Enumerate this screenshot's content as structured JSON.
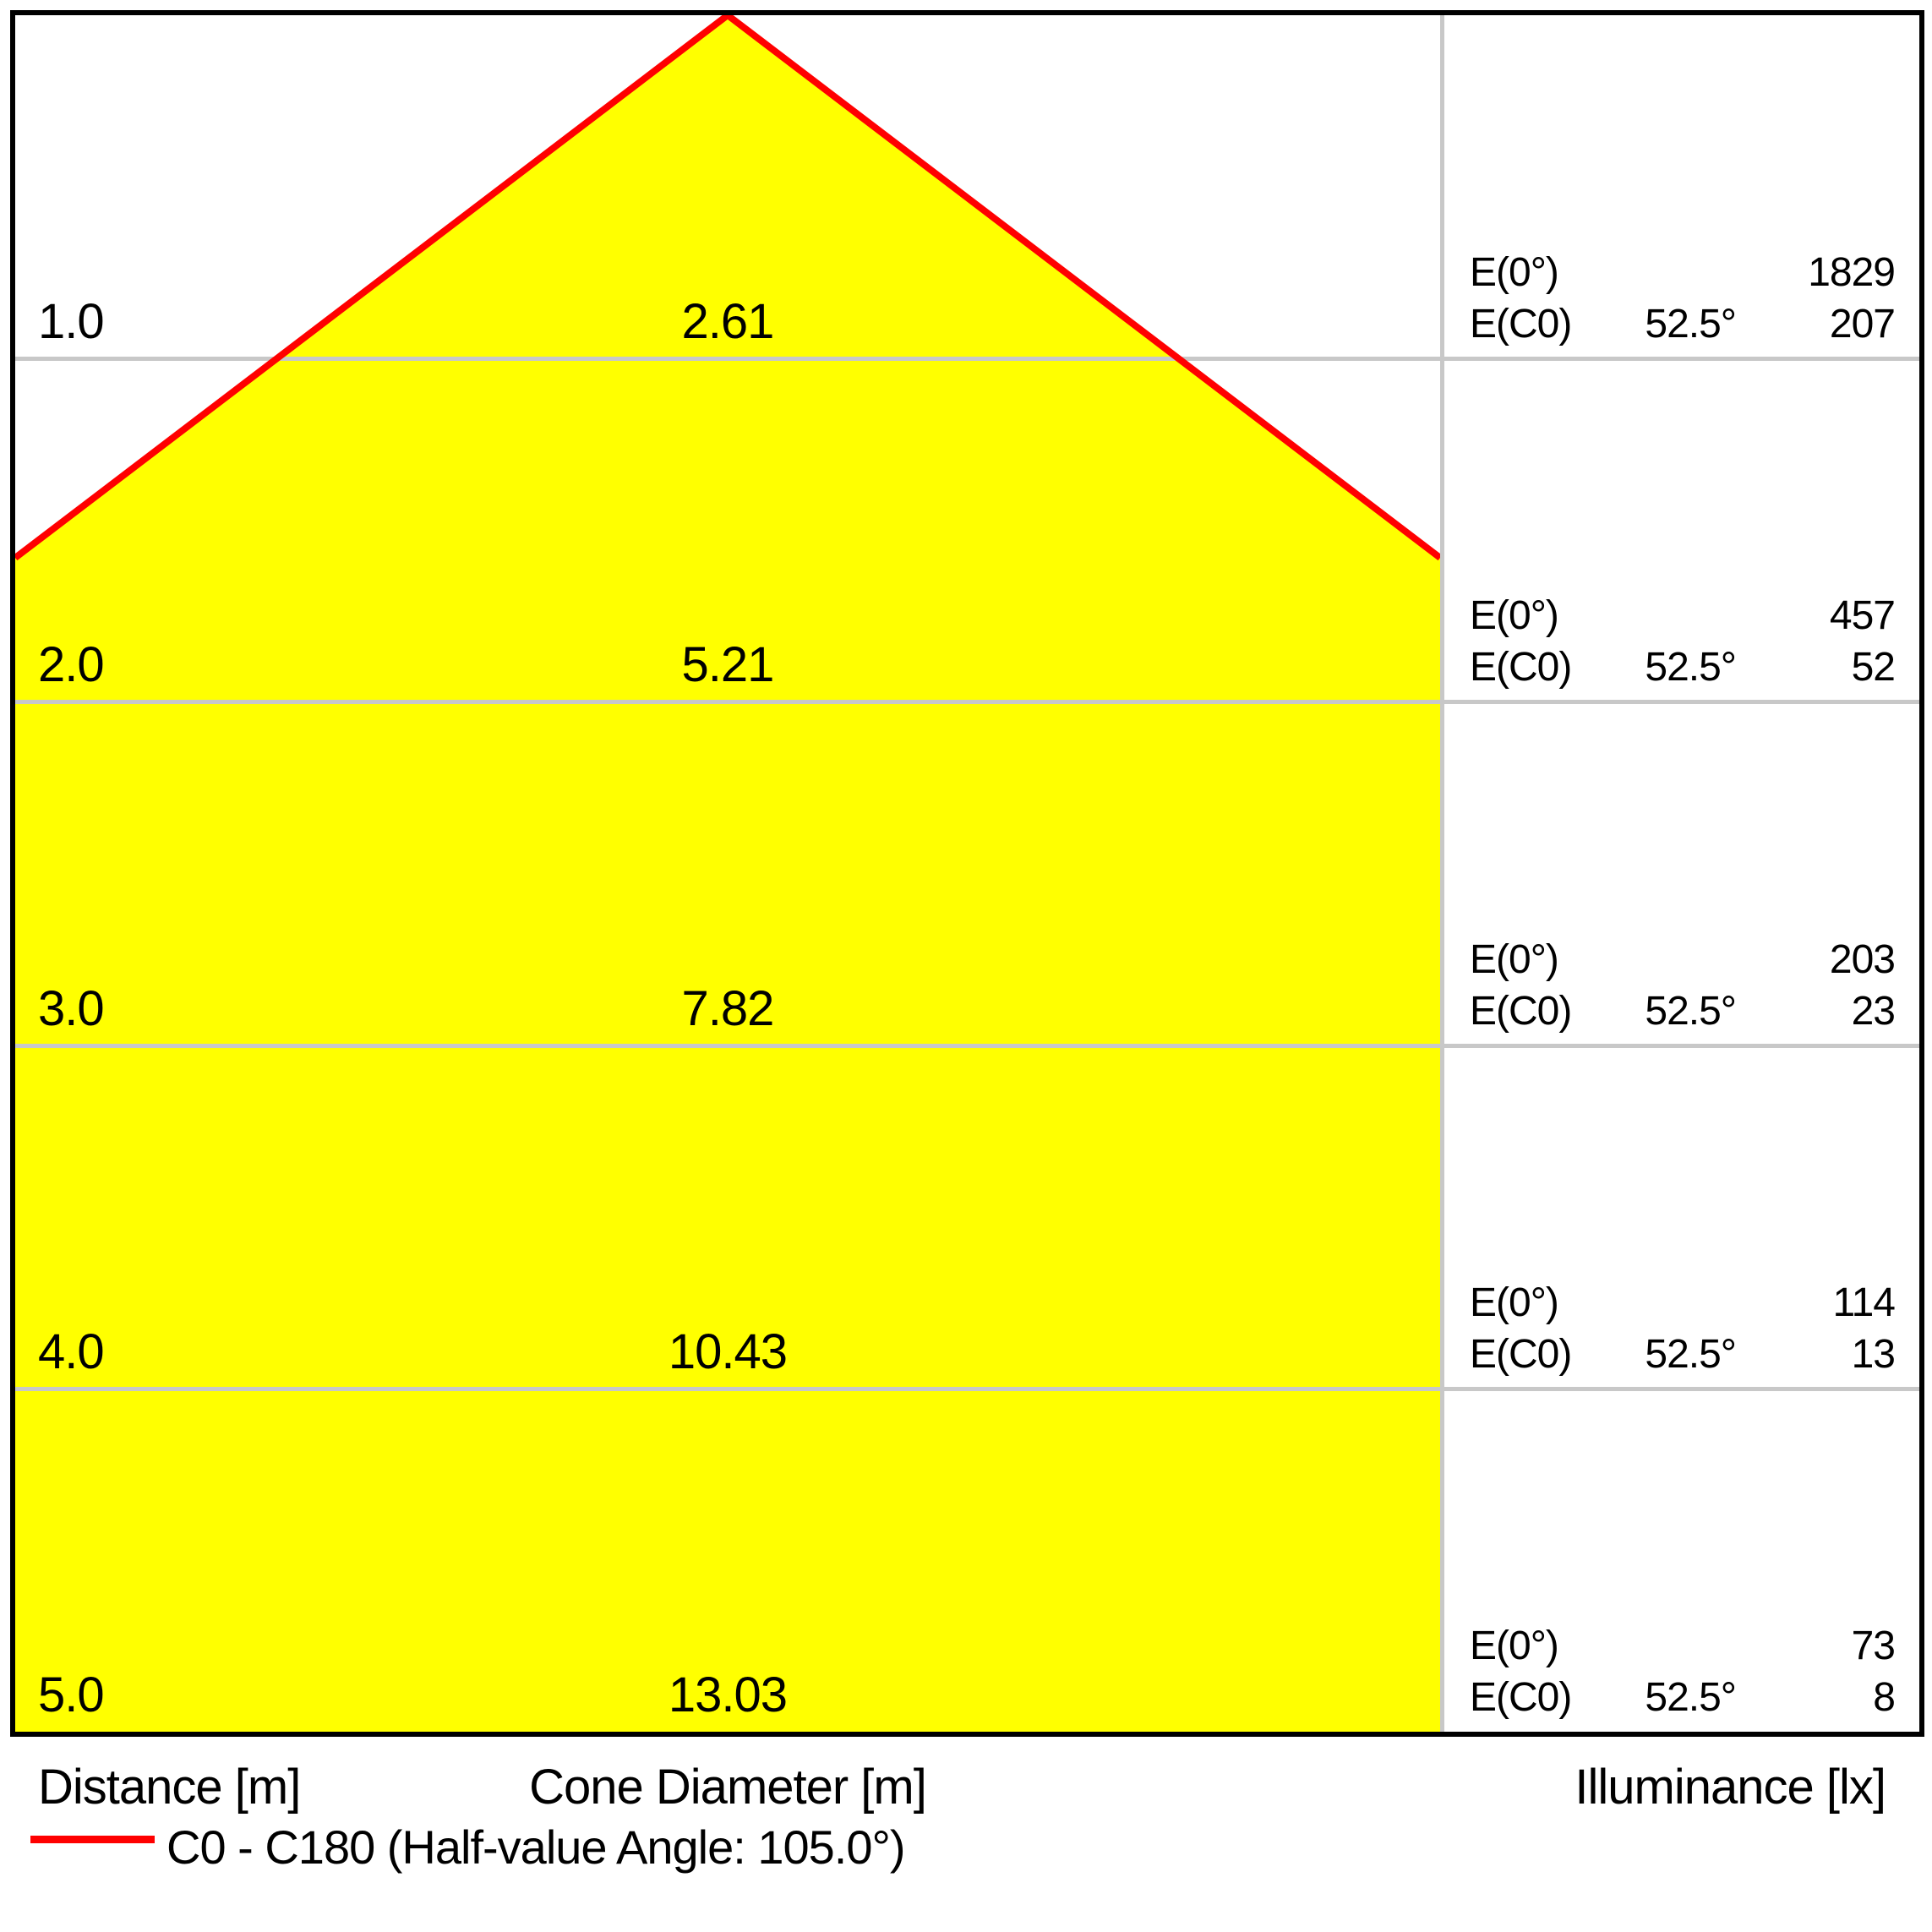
{
  "colors": {
    "cone_fill": "#ffff00",
    "beam_line": "#ff0000",
    "grid_line": "#c8c8c8",
    "border": "#000000",
    "text": "#000000",
    "background": "#ffffff"
  },
  "footer": {
    "distance_label": "Distance [m]",
    "cone_diameter_label": "Cone Diameter [m]",
    "illuminance_label": "Illuminance [lx]"
  },
  "legend": {
    "label": "C0 - C180 (Half-value Angle: 105.0°)"
  },
  "chart_data": {
    "type": "area",
    "chart_kind": "photometric light cone diagram",
    "xlabel": "Distance [m]",
    "x": [
      1.0,
      2.0,
      3.0,
      4.0,
      5.0
    ],
    "series": [
      {
        "name": "Cone Diameter [m]",
        "values": [
          2.61,
          5.21,
          7.82,
          10.43,
          13.03
        ]
      },
      {
        "name": "E(0°) Illuminance [lx]",
        "values": [
          1829,
          457,
          203,
          114,
          73
        ]
      },
      {
        "name": "E(C0) 52.5° Illuminance [lx]",
        "values": [
          207,
          52,
          23,
          13,
          8
        ]
      }
    ],
    "beam_angle_deg": 52.5,
    "half_value_angle_deg": 105.0,
    "legend_entry": "C0 - C180 (Half-value Angle: 105.0°)",
    "legend_position": "bottom-left",
    "grid": true,
    "rows": [
      {
        "distance": "1.0",
        "diameter": "2.61",
        "e0_label": "E(0°)",
        "e0_value": "1829",
        "ec0_label": "E(C0)",
        "angle": "52.5°",
        "ec0_value": "207"
      },
      {
        "distance": "2.0",
        "diameter": "5.21",
        "e0_label": "E(0°)",
        "e0_value": "457",
        "ec0_label": "E(C0)",
        "angle": "52.5°",
        "ec0_value": "52"
      },
      {
        "distance": "3.0",
        "diameter": "7.82",
        "e0_label": "E(0°)",
        "e0_value": "203",
        "ec0_label": "E(C0)",
        "angle": "52.5°",
        "ec0_value": "23"
      },
      {
        "distance": "4.0",
        "diameter": "10.43",
        "e0_label": "E(0°)",
        "e0_value": "114",
        "ec0_label": "E(C0)",
        "angle": "52.5°",
        "ec0_value": "13"
      },
      {
        "distance": "5.0",
        "diameter": "13.03",
        "e0_label": "E(0°)",
        "e0_value": "73",
        "ec0_label": "E(C0)",
        "angle": "52.5°",
        "ec0_value": "8"
      }
    ]
  }
}
